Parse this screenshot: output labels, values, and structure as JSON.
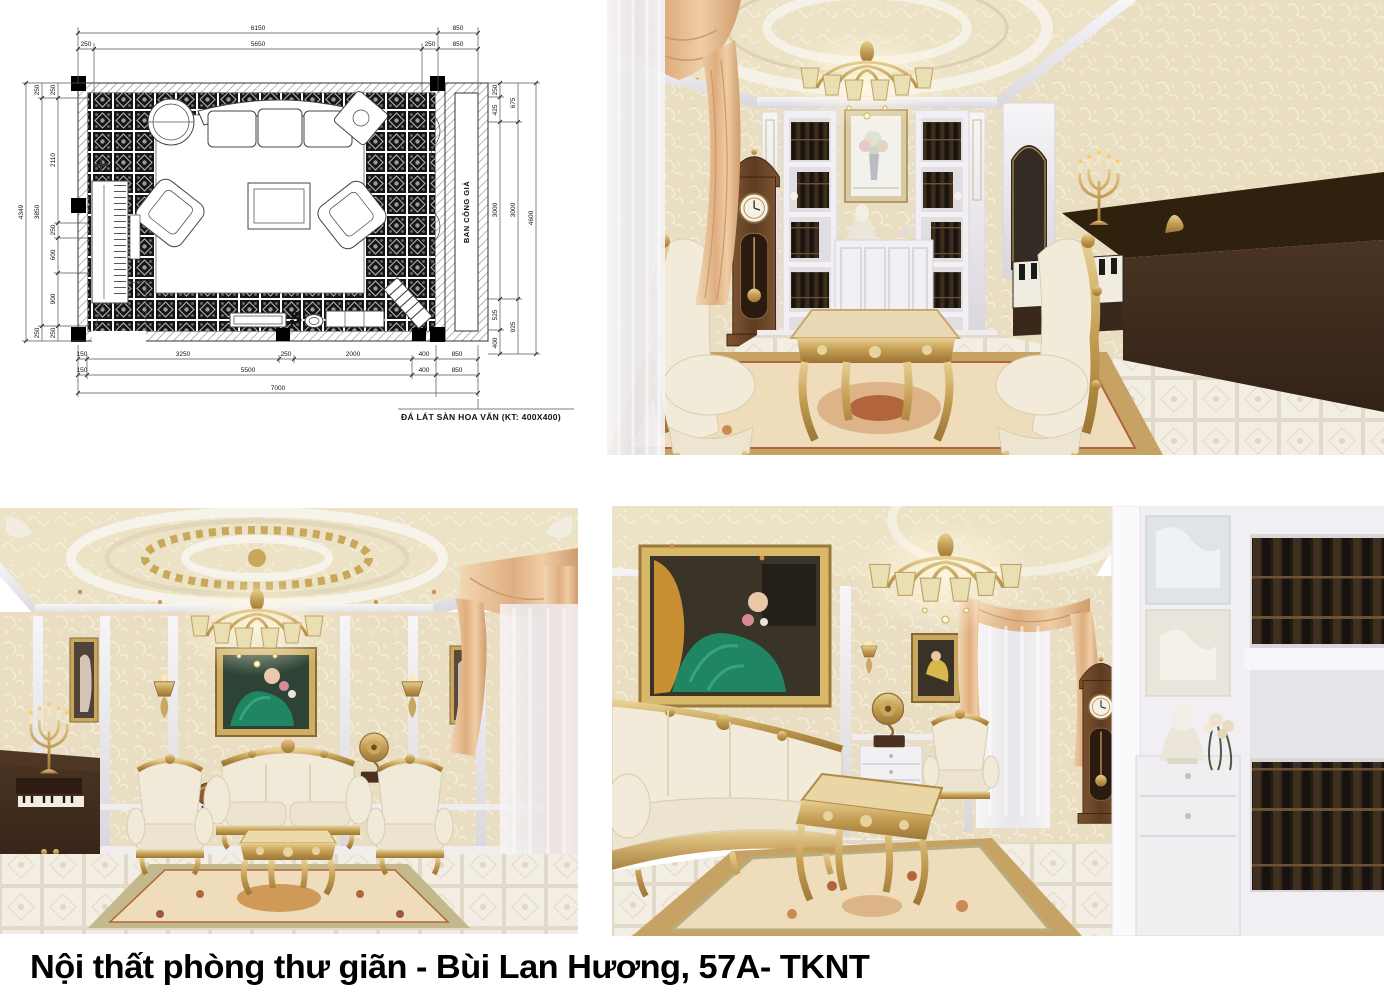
{
  "caption": "Nội thất phòng thư giãn - Bùi Lan Hương, 57A- TKNT",
  "floorplan": {
    "t1": [
      "6150",
      "850"
    ],
    "t2": [
      "250",
      "5650",
      "250",
      "850"
    ],
    "l1": "4349",
    "l2": [
      "250",
      "3850",
      "250"
    ],
    "l3": [
      "250",
      "2110",
      "250",
      "600",
      "900",
      "250"
    ],
    "r1": [
      "250",
      "425",
      "3000",
      "525",
      "400"
    ],
    "r2": [
      "675",
      "3000",
      "925"
    ],
    "r3": "4600",
    "b1": [
      "150",
      "3250",
      "250",
      "2000",
      "400",
      "850"
    ],
    "b2": [
      "150",
      "5500",
      "400",
      "850"
    ],
    "b3": "7000",
    "balcony_label": "BAN CÔNG GIẢ",
    "door_label": "W740",
    "floor_note": "ĐÁ LÁT SÀN HOA VĂN (KT: 400X400)"
  },
  "palette": {
    "ceiling": "#ece2c6",
    "wallpaper": "#e9dec2",
    "molding": "#efedf1",
    "curtain_peach": "#e9c49c",
    "sheer": "#f4f2f4",
    "gold": "#c8a356",
    "wood_piano": "#3c2a1e",
    "wood_clock": "#6d4526",
    "upholstery": "#f1ead8",
    "rug_field": "#eedcba",
    "rug_border": "#c7a265",
    "rug_accent": "#b2653c",
    "floor_tile": "#f2ede2",
    "books": "#3a2d1f",
    "painting_green": "#1f8563"
  }
}
